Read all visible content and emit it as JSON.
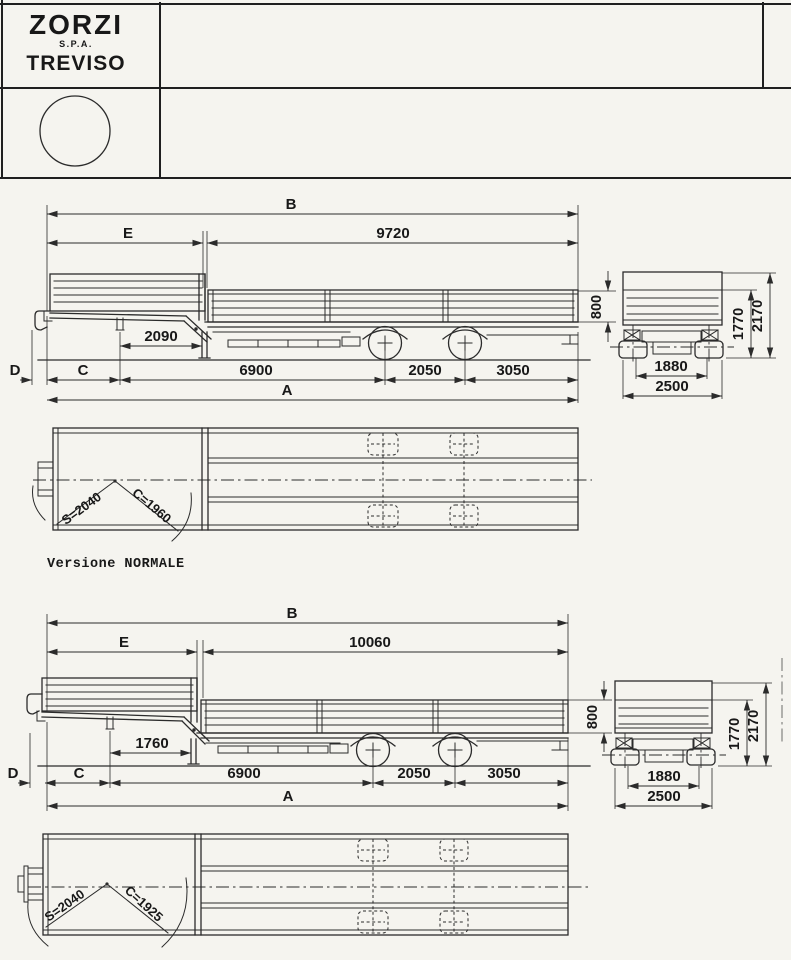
{
  "title_block": {
    "brand": "ZORZI",
    "brand_suffix": "S.P.A.",
    "city": "TREVISO"
  },
  "caption": "Versione NORMALE",
  "normale": {
    "B": "B",
    "E": "E",
    "top_length": "9720",
    "neck": "2090",
    "D": "D",
    "C": "C",
    "front_axle_dist": "6900",
    "axle_spacing": "2050",
    "rear_overhang": "3050",
    "A": "A",
    "board_height": "800",
    "side_height": "1770",
    "total_height": "2170",
    "inner_track": "1880",
    "overall_width": "2500",
    "swing_s": "S=2040",
    "swing_c": "C=1960"
  },
  "lunga": {
    "B": "B",
    "E": "E",
    "top_length": "10060",
    "neck": "1760",
    "D": "D",
    "C": "C",
    "front_axle_dist": "6900",
    "axle_spacing": "2050",
    "rear_overhang": "3050",
    "A": "A",
    "board_height": "800",
    "side_height": "1770",
    "total_height": "2170",
    "inner_track": "1880",
    "overall_width": "2500",
    "swing_s": "S=2040",
    "swing_c": "C=1925"
  }
}
